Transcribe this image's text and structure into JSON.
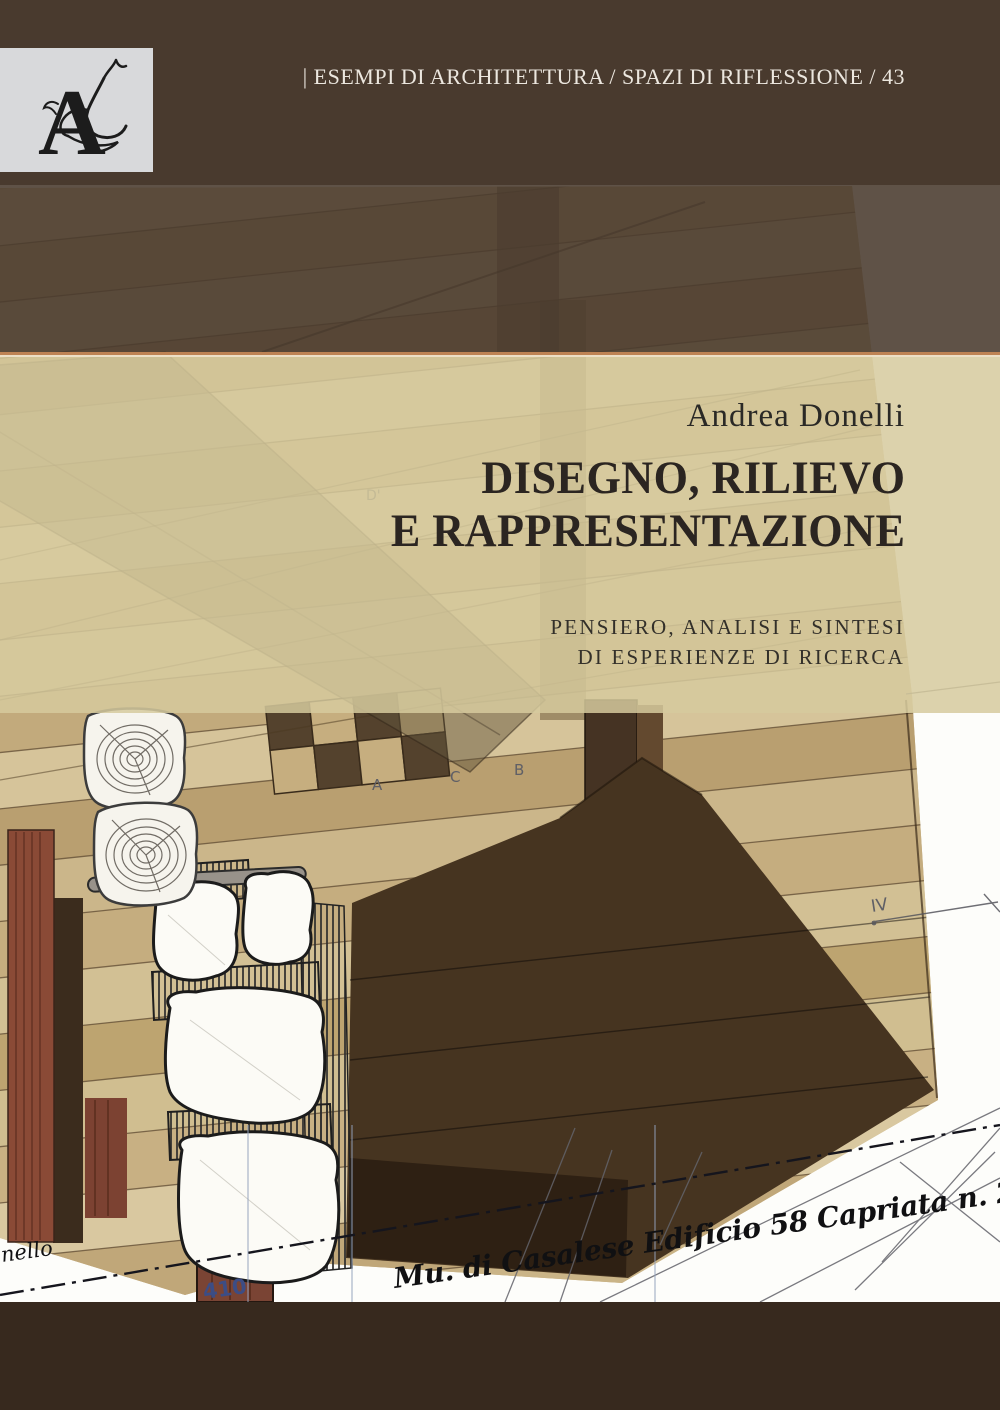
{
  "series": {
    "label": "| ESEMPI DI ARCHITETTURA / SPAZI DI RIFLESSIONE / 43",
    "series_number": "43"
  },
  "publisher": {
    "logo_letter": "A"
  },
  "author": "Andrea Donelli",
  "title": {
    "line1": "DISEGNO, RILIEVO",
    "line2": "E RAPPRESENTAZIONE"
  },
  "subtitle": {
    "line1": "PENSIERO, ANALISI E SINTESI",
    "line2": "DI ESPERIENZE DI RICERCA"
  },
  "drawing_annotations": {
    "handwriting_main": "Mu. di Casalese Edificio 58 Capriata n. 2",
    "handwriting_left": "nello",
    "dimension": "410",
    "label_iv": "IV",
    "label_a": "A",
    "label_c": "C",
    "label_b": "B",
    "label_d": "D'"
  },
  "colors": {
    "top_band_brown": "#493b31",
    "bottom_band_brown": "#37291e",
    "beige_band": "#d6ca9e",
    "separator_orange": "#be8354",
    "logo_box_gray": "#d8d9db",
    "title_ink": "#2b2521",
    "dimension_blue": "#3c4d85",
    "wood_tan": "#c9b286",
    "red_post": "#8a4a36"
  }
}
